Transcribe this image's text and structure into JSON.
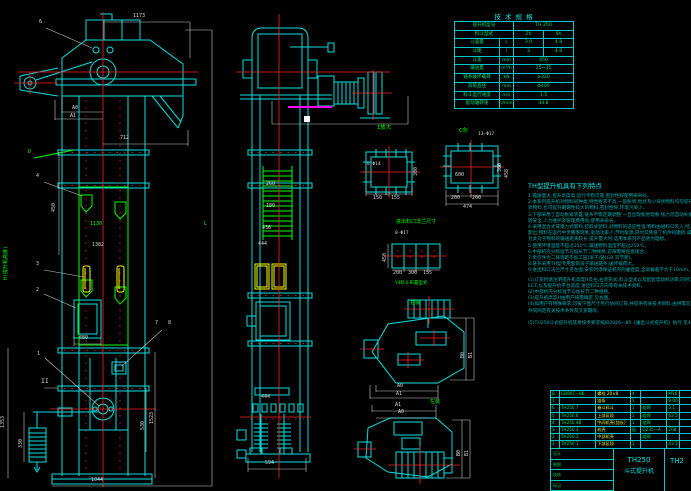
{
  "colors": {
    "bg": "#000000",
    "cyan": "#00e0e0",
    "green": "#00ff00",
    "red": "#ff2222",
    "yellow": "#ffff00",
    "magenta": "#ff00ff",
    "dim": "#d8d8d8",
    "teal": "#00b0b0"
  },
  "spec_table": {
    "title": "技 术 规 格",
    "rows": [
      [
        {
          "t": "提升机型号",
          "w": 58
        },
        {
          "t": "TH 250",
          "w": 60
        }
      ],
      [
        {
          "t": "料斗型式",
          "w": 58
        },
        {
          "t": "Zh",
          "w": 30
        },
        {
          "t": "Sh",
          "w": 30
        }
      ],
      [
        {
          "t": "斗容量",
          "w": 44
        },
        {
          "t": "L",
          "w": 14
        },
        {
          "t": "3.0",
          "w": 30
        },
        {
          "t": "4.8",
          "w": 30
        }
      ],
      [
        {
          "t": "斗距",
          "w": 44
        },
        {
          "t": "l",
          "w": 14
        },
        {
          "t": "3",
          "w": 30
        },
        {
          "t": "4.8",
          "w": 30
        }
      ],
      [
        {
          "t": "斗宽",
          "w": 44
        },
        {
          "t": "mm",
          "w": 14
        },
        {
          "t": "450",
          "w": 60
        }
      ],
      [
        {
          "t": "输送量",
          "w": 44
        },
        {
          "t": "m³/h",
          "w": 14
        },
        {
          "t": "25~35",
          "w": 60
        }
      ],
      [
        {
          "t": "链条破坏载荷",
          "w": 44
        },
        {
          "t": "kN",
          "w": 14
        },
        {
          "t": "≥320",
          "w": 60
        }
      ],
      [
        {
          "t": "滚筒直径",
          "w": 44
        },
        {
          "t": "mm",
          "w": 14
        },
        {
          "t": "Φ400",
          "w": 60
        }
      ],
      [
        {
          "t": "料斗运行速度",
          "w": 44
        },
        {
          "t": "m/s",
          "w": 14
        },
        {
          "t": "1.5",
          "w": 60
        }
      ],
      [
        {
          "t": "驱动轴转速",
          "w": 44
        },
        {
          "t": "r/min",
          "w": 14
        },
        {
          "t": "44.8",
          "w": 60
        }
      ]
    ]
  },
  "notes": {
    "title": "TH型提升机具有下列特点",
    "lines": [
      "1.输送量大,提升高度高,运行平稳可靠,密封性好使用寿命长。",
      "2.本系列提升机对物料的种类,特性要求不高,一般粉状,粒状及小块状物料均可提升,既可提升一般性粉",
      "  状物料,也可提升磨琢性较大的物料,密封性好,环境污染少。",
      "3.下部采用了自动张紧装置,链条不需定期调整,一旦出现松弛现象,张力可自动补偿,避免打滑及脱链,运",
      "  转安全,人力维护及管理费用低,使用寿命长。",
      "4.采用混合式或重力式卸料,挖取式装料,对物料的适应性强,物料由进料口装入,经工作运转后由卸料口",
      "  卸出,物料在运行中无撒落现象,驱动功率小,节约能源,同时又降低了机件的磨损,噪音小。",
      "  为此对于物料的输送距离较长,提升量大时,选用本系列产品更为理想。",
      "5.使用环境温度不超过250℃,输送物料温度不超过250℃。",
      "6.中部机壳分标准节与加长节二种规格,可按需要任意组合。",
      "7.牵引件为二排等距不加工园(滚子)链(GB 双节距)。",
      "8.链条采用TH型专用套筒滚子输送链条,破坏载荷大。",
      "9.进出料口法兰尺寸见左图,安装时须保证机壳的垂直度,全高偏差不大于10mm。",
      "",
      "(1)订货时请注明提升机高度H及左,右装形式,料斗型式以及配套电动机功率,同时注明",
      "  ECT,以及提升机平台高度,进出料口方向等有关技术资料。",
      "(2)中部机壳分标准节与加长节二种规格。",
      "(3)提升机高度H由用户按需确定,见右图。",
      "(4)如用户有特殊要求,可按下图尺寸另行协商订货,并提供有关技术资料,由供需双方,",
      "  共同商定有关技术条件及交货期限。",
      "",
      "",
      "(5)TH250斗式提升机其余技术要求按JB3926—85《垂直斗式提升机》执行 见4D。"
    ]
  },
  "bom": {
    "rows": [
      [
        "8",
        "GB907—86",
        "螺栓 20×8",
        "4",
        "",
        "M16",
        ""
      ],
      [
        "7",
        "",
        "链条",
        "1",
        "",
        "9.06",
        ""
      ],
      [
        "6",
        "TH250.7",
        "畚斗料斗",
        "1",
        "组焊",
        "3.1",
        ""
      ],
      [
        "5",
        "TH250.6",
        "上部区段",
        "1",
        "组焊",
        "63.5",
        ""
      ],
      [
        "4",
        "TH250.4B",
        "中间机壳(加长)",
        "1",
        "组焊",
        "",
        ""
      ],
      [
        "3",
        "TH250.3",
        "机壳",
        "段",
        "Q235—A",
        "208",
        ""
      ],
      [
        "2",
        "TH250.2",
        "中部机壳",
        "",
        "组焊",
        "",
        ""
      ],
      [
        "1",
        "TH250.1",
        "下部区段",
        "1",
        "",
        "43.2",
        ""
      ],
      [
        "序号",
        "代 号",
        "名 称",
        "数量",
        "材 料",
        "单件",
        "总计"
      ]
    ]
  },
  "title_block": {
    "model": "TH250",
    "name": "斗式提升机",
    "right_code": "TH2",
    "left_labels": [
      "设计",
      "制图",
      "校核",
      "标记"
    ]
  },
  "annotations": [
    {
      "t": "1173",
      "x": 133,
      "y": 14,
      "c": "w"
    },
    {
      "t": "712",
      "x": 120,
      "y": 136,
      "c": "w"
    },
    {
      "t": "A0",
      "x": 72,
      "y": 106,
      "c": "w"
    },
    {
      "t": "A1",
      "x": 70,
      "y": 114,
      "c": "w"
    },
    {
      "t": "6",
      "x": 39,
      "y": 20,
      "c": "w"
    },
    {
      "t": "D",
      "x": 28,
      "y": 150,
      "c": "g"
    },
    {
      "t": "4",
      "x": 36,
      "y": 174,
      "c": "w"
    },
    {
      "t": "450",
      "x": 52,
      "y": 212,
      "c": "w",
      "r": 1
    },
    {
      "t": "1130",
      "x": 90,
      "y": 222,
      "c": "g"
    },
    {
      "t": "1382",
      "x": 92,
      "y": 243,
      "c": "w"
    },
    {
      "t": "3",
      "x": 36,
      "y": 262,
      "c": "w"
    },
    {
      "t": "2",
      "x": 36,
      "y": 288,
      "c": "w"
    },
    {
      "t": "1",
      "x": 37,
      "y": 352,
      "c": "w"
    },
    {
      "t": "7",
      "x": 155,
      "y": 321,
      "c": "w"
    },
    {
      "t": "8",
      "x": 168,
      "y": 321,
      "c": "w"
    },
    {
      "t": "II",
      "x": 41,
      "y": 378,
      "c": "w",
      "s": 6.5
    },
    {
      "t": "480",
      "x": 79,
      "y": 336,
      "c": "w"
    },
    {
      "t": "330",
      "x": 19,
      "y": 448,
      "c": "w",
      "r": 1
    },
    {
      "t": "1353",
      "x": 1,
      "y": 428,
      "c": "w",
      "r": 1
    },
    {
      "t": "530",
      "x": 141,
      "y": 430,
      "c": "w",
      "r": 1
    },
    {
      "t": "1523",
      "x": 150,
      "y": 424,
      "c": "w",
      "r": 1
    },
    {
      "t": "1044",
      "x": 91,
      "y": 478,
      "c": "w"
    },
    {
      "t": "L",
      "x": 204,
      "y": 222,
      "c": "g"
    },
    {
      "t": "H(提升机高度)",
      "x": 4,
      "y": 280,
      "c": "g",
      "r": 1,
      "s": 5
    },
    {
      "t": "260",
      "x": 266,
      "y": 182,
      "c": "w"
    },
    {
      "t": "180",
      "x": 266,
      "y": 204,
      "c": "w"
    },
    {
      "t": "436",
      "x": 262,
      "y": 226,
      "c": "w"
    },
    {
      "t": "444",
      "x": 258,
      "y": 242,
      "c": "w"
    },
    {
      "t": "444",
      "x": 261,
      "y": 395,
      "c": "w"
    },
    {
      "t": "594",
      "x": 265,
      "y": 461,
      "c": "w"
    },
    {
      "t": "I放大",
      "x": 377,
      "y": 126,
      "c": "g",
      "s": 5.5
    },
    {
      "t": "8-Φ14",
      "x": 367,
      "y": 163,
      "c": "w",
      "s": 4.5
    },
    {
      "t": "300",
      "x": 414,
      "y": 176,
      "c": "w",
      "r": 1
    },
    {
      "t": "150",
      "x": 373,
      "y": 196,
      "c": "w"
    },
    {
      "t": "155",
      "x": 391,
      "y": 196,
      "c": "w"
    },
    {
      "t": "C向",
      "x": 459,
      "y": 129,
      "c": "g",
      "s": 5.5
    },
    {
      "t": "13-Φ17",
      "x": 478,
      "y": 133,
      "c": "w",
      "s": 4.5
    },
    {
      "t": "600",
      "x": 455,
      "y": 173,
      "c": "w"
    },
    {
      "t": "200",
      "x": 451,
      "y": 196,
      "c": "w"
    },
    {
      "t": "200",
      "x": 472,
      "y": 196,
      "c": "w"
    },
    {
      "t": "474",
      "x": 463,
      "y": 205,
      "c": "w"
    },
    {
      "t": "300",
      "x": 498,
      "y": 172,
      "c": "w",
      "r": 1
    },
    {
      "t": "458",
      "x": 505,
      "y": 178,
      "c": "w",
      "r": 1
    },
    {
      "t": "进出料口法兰尺寸",
      "x": 396,
      "y": 220,
      "c": "g",
      "s": 5
    },
    {
      "t": "8-Φ17",
      "x": 395,
      "y": 232,
      "c": "w",
      "s": 4.5
    },
    {
      "t": "450",
      "x": 383,
      "y": 262,
      "c": "w",
      "r": 1
    },
    {
      "t": "200",
      "x": 393,
      "y": 271,
      "c": "w"
    },
    {
      "t": "300",
      "x": 408,
      "y": 271,
      "c": "w"
    },
    {
      "t": "155",
      "x": 423,
      "y": 271,
      "c": "w"
    },
    {
      "t": "Y4料斗布置型式",
      "x": 395,
      "y": 282,
      "c": "g",
      "s": 4.5
    },
    {
      "t": "右装",
      "x": 410,
      "y": 301,
      "c": "g",
      "s": 5
    },
    {
      "t": "A0",
      "x": 397,
      "y": 384,
      "c": "w"
    },
    {
      "t": "A1",
      "x": 396,
      "y": 392,
      "c": "w"
    },
    {
      "t": "左装",
      "x": 430,
      "y": 400,
      "c": "g",
      "s": 5
    },
    {
      "t": "A1",
      "x": 395,
      "y": 403,
      "c": "w"
    },
    {
      "t": "A0",
      "x": 398,
      "y": 410,
      "c": "w"
    },
    {
      "t": "B0",
      "x": 461,
      "y": 358,
      "c": "w",
      "r": 1
    },
    {
      "t": "B1",
      "x": 469,
      "y": 358,
      "c": "w",
      "r": 1
    },
    {
      "t": "B0",
      "x": 457,
      "y": 456,
      "c": "w",
      "r": 1
    },
    {
      "t": "B1",
      "x": 465,
      "y": 456,
      "c": "w",
      "r": 1
    }
  ]
}
